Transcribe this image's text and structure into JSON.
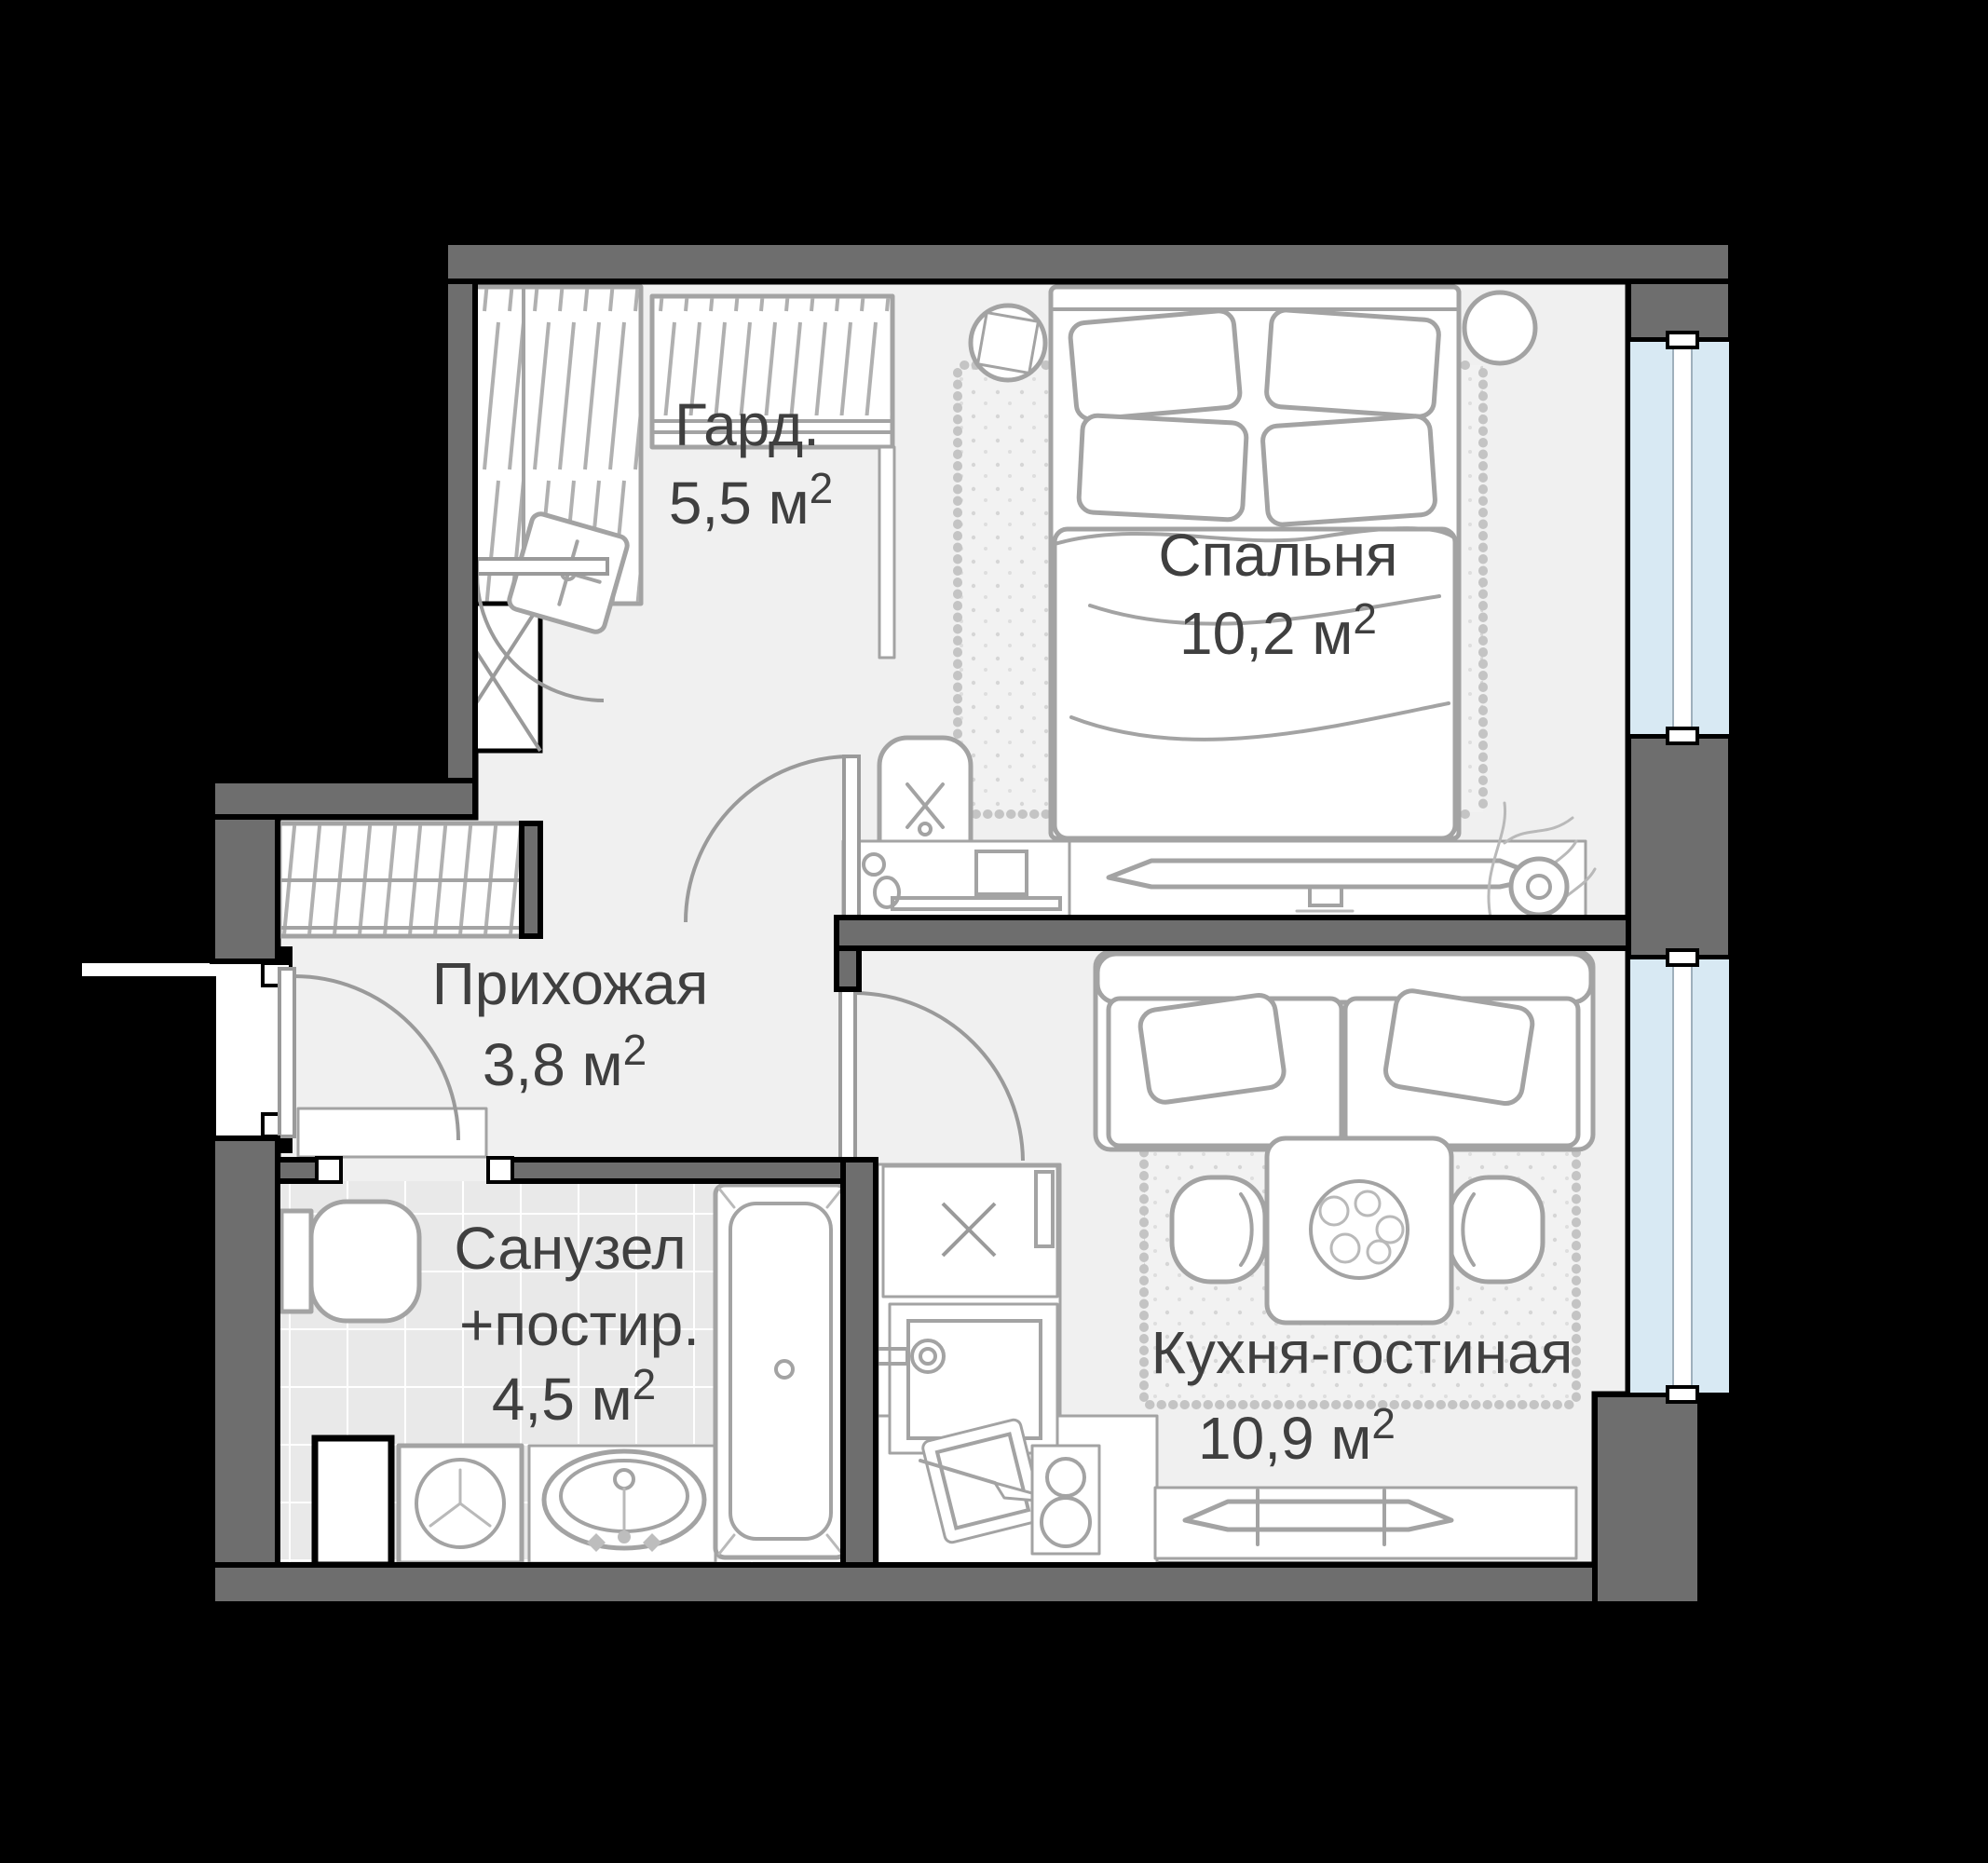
{
  "plan": {
    "background": "#000000",
    "wall_color": "#6e6e6e",
    "floor_color": "#f0f0f0",
    "tile_color": "#e9e9e9",
    "glass_color": "#d8e9f3",
    "outline_color": "#000000",
    "furniture_stroke": "#a3a3a3",
    "text_color": "#3f3f3f"
  },
  "rooms": {
    "wardrobe": {
      "name": "Гард.",
      "area": "5,5 м",
      "sup": "2"
    },
    "bedroom": {
      "name": "Спальня",
      "area": "10,2 м",
      "sup": "2"
    },
    "hallway": {
      "name": "Прихожая",
      "area": "3,8 м",
      "sup": "2"
    },
    "bathroom": {
      "name": "Санузел",
      "name_line2": "+постир.",
      "area": "4,5 м",
      "sup": "2"
    },
    "kitchen_living": {
      "name": "Кухня-гостиная",
      "area": "10,9 м",
      "sup": "2"
    }
  },
  "furniture_icons": [
    "double-bed",
    "pillow",
    "blanket",
    "round-nightstand",
    "square-nightstand",
    "rug-with-fringe",
    "desk",
    "desk-chair",
    "tv-panel",
    "tv-console",
    "plant-pot",
    "sofa",
    "sofa-pillow",
    "dining-table",
    "food-plate",
    "dining-chair",
    "kitchen-hob",
    "kitchen-sink",
    "cutting-board",
    "knife",
    "oven-burners",
    "toilet",
    "washing-machine",
    "bathroom-sink",
    "bathtub",
    "pouf",
    "wardrobe-closet",
    "shelf-closet",
    "coat-closet",
    "vent-shaft",
    "window-glass",
    "door-leaf",
    "door-swing-arc",
    "entry-threshold"
  ]
}
